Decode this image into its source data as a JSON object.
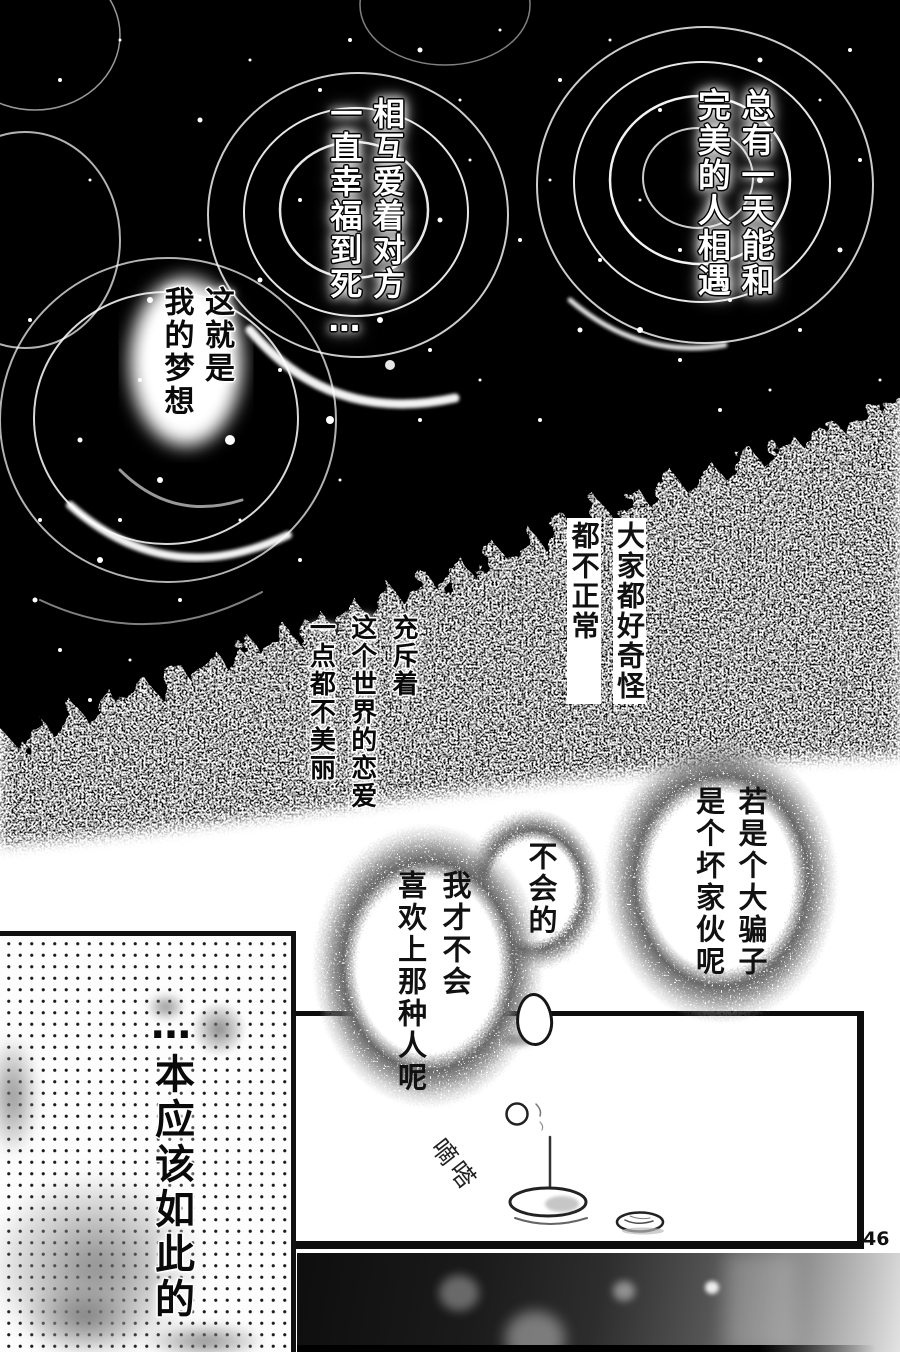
{
  "page": {
    "number": "46"
  },
  "narration": {
    "dream_meet": {
      "lines": [
        "总有一天能和",
        "完美的人相遇"
      ]
    },
    "dream_love": {
      "lines": [
        "相互爱着对方",
        "一直幸福到死…"
      ]
    },
    "dream_is": {
      "lines": [
        "这就是",
        "我的梦想"
      ]
    },
    "weird": {
      "lines": [
        "大家都好奇怪",
        "都不正常"
      ]
    },
    "ugly_love": {
      "lines": [
        "充斥着",
        "这个世界的恋爱",
        "一点都不美丽"
      ]
    },
    "should_be": {
      "lines": [
        "…本应该如此的"
      ]
    }
  },
  "speech": {
    "bad_guy": {
      "lines": [
        "若是个大骗子",
        "是个坏家伙呢"
      ]
    },
    "no_way": {
      "lines": [
        "不会的"
      ]
    },
    "never_like": {
      "lines": [
        "我才不会",
        "喜欢上那种人呢"
      ]
    }
  },
  "sfx": {
    "drip": "嘀嗒"
  },
  "colors": {
    "ink": "#0d0d0d",
    "paper": "#ffffff"
  }
}
